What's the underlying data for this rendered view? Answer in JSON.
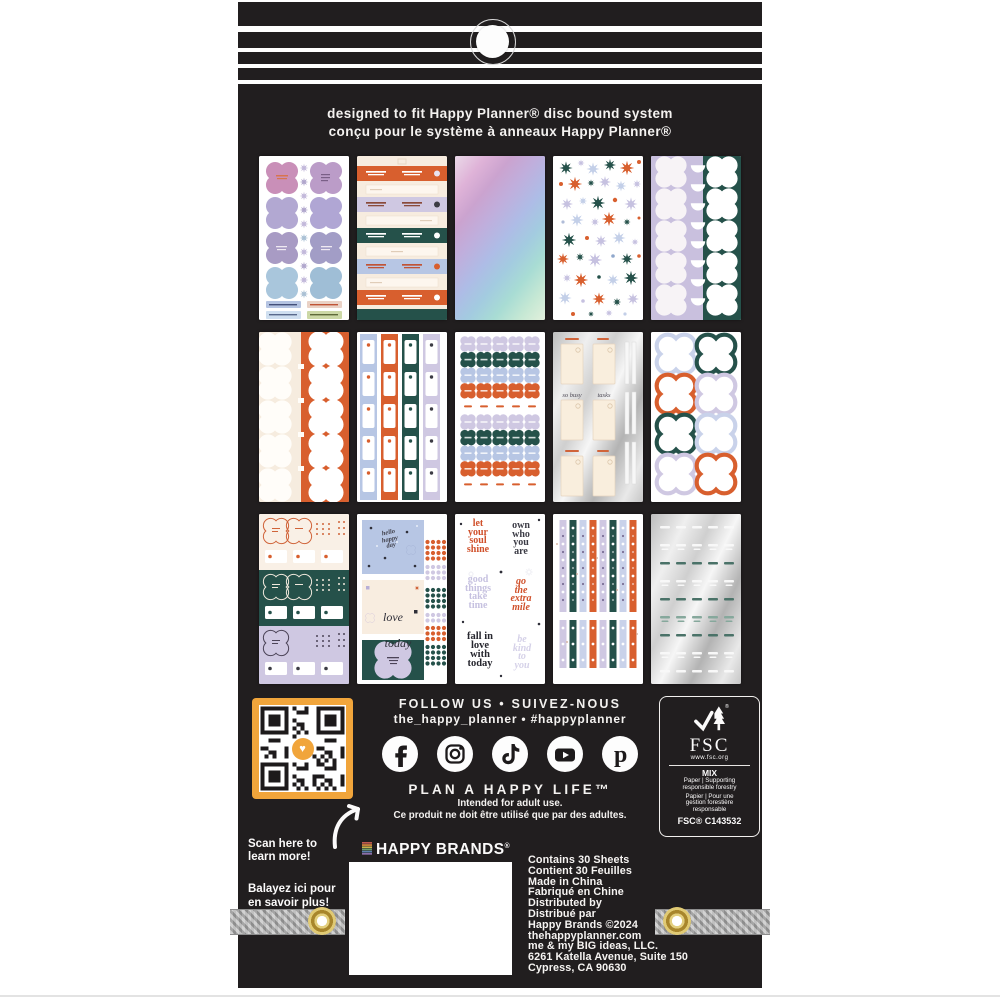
{
  "colors": {
    "package_black": "#211e1f",
    "orange": "#d85f2e",
    "teal": "#25514a",
    "lavender": "#cfc8e2",
    "periwinkle": "#b7c6e4",
    "cream": "#f7ecdf",
    "qr_frame": "#f1a53b",
    "grommet_gold": "#a8862c",
    "ribbon_grey": "#a2a2a2"
  },
  "header": {
    "line1": "designed to fit Happy Planner® disc bound system",
    "line2": "conçu pour le système à anneaux Happy Planner®"
  },
  "sheets": [
    {
      "name": "clover-stickers",
      "description": "white sheet, pink/purple/blue clover stickers, small stars, label banners"
    },
    {
      "name": "banner-labels",
      "description": "cream sheet with orange, lavender, teal and blue banner labels"
    },
    {
      "name": "holographic",
      "description": "holographic pink-purple-blue foil sheet"
    },
    {
      "name": "starburst-flowers",
      "description": "white sheet with orange, teal, lavender and blue starburst flowers"
    },
    {
      "name": "clover-columns",
      "description": "lavender and teal sheet with white clovers and half-circles"
    },
    {
      "name": "clover-split",
      "description": "cream and orange sheet with white clover stickers"
    },
    {
      "name": "tab-strips",
      "description": "blue, orange, teal and lavender strips with white tab labels"
    },
    {
      "name": "mini-labels",
      "description": "grid of small quatrefoil labels in lavender, teal, blue, orange"
    },
    {
      "name": "foil-lists",
      "description": "silver foil sheet with cream list pads and thin strips"
    },
    {
      "name": "clover-outlines",
      "description": "white sheet with large clover outline stickers"
    },
    {
      "name": "band-sampler",
      "description": "cream, teal and lavender bands with clovers, dots and tags"
    },
    {
      "name": "quote-blocks",
      "description": "blue, cream and teal blocks with phrases and dot grids"
    },
    {
      "name": "word-art",
      "description": "white sheet with stacked serif phrases"
    },
    {
      "name": "washi-strips",
      "description": "lavender, teal, blue and orange dotted washi strips"
    },
    {
      "name": "foil-words",
      "description": "silver foil sheet with rows of tiny word stickers"
    }
  ],
  "sticker_texts": {
    "foil_list_caption1": "so busy",
    "foil_list_caption2": "tasks",
    "hello_block": "hello\nhappy\nday",
    "love_line1": "love",
    "love_line2": "today",
    "word_art": [
      "let\nyour\nsoul\nshine",
      "own\nwho\nyou\nare",
      "good\nthings\ntake\ntime",
      "go\nthe\nextra\nmile",
      "fall in\nlove\nwith\ntoday",
      "be\nkind\nto\nyou"
    ]
  },
  "footer": {
    "follow_line1": "FOLLOW US • SUIVEZ-NOUS",
    "follow_line2": "the_happy_planner • #happyplanner",
    "social_icons": [
      "Facebook",
      "Instagram",
      "TikTok",
      "YouTube",
      "Pinterest"
    ],
    "tagline": "PLAN A HAPPY LIFE™",
    "adult_en": "Intended for adult use.",
    "adult_fr": "Ce produit ne doit être utilisé que par des adultes.",
    "scan_en": "Scan here to\nlearn more!",
    "scan_fr": "Balayez ici pour\nen savoir plus!",
    "fsc": {
      "acronym": "FSC",
      "url": "www.fsc.org",
      "grade": "MIX",
      "en": "Paper | Supporting\nresponsible forestry",
      "fr": "Papier | Pour une\ngestion forestière\nresponsable",
      "cert": "FSC® C143532"
    },
    "brand": "HAPPY BRANDS",
    "brand_reg": "®",
    "info_lines": [
      "Contains 30 Sheets",
      "Contient 30 Feuilles",
      "Made in China",
      "Fabriqué en Chine",
      "Distributed by",
      "Distribué par",
      "Happy Brands ©2024",
      "thehappyplanner.com",
      "me & my BIG ideas, LLC.",
      "6261 Katella Avenue, Suite 150",
      "Cypress, CA 90630"
    ]
  }
}
